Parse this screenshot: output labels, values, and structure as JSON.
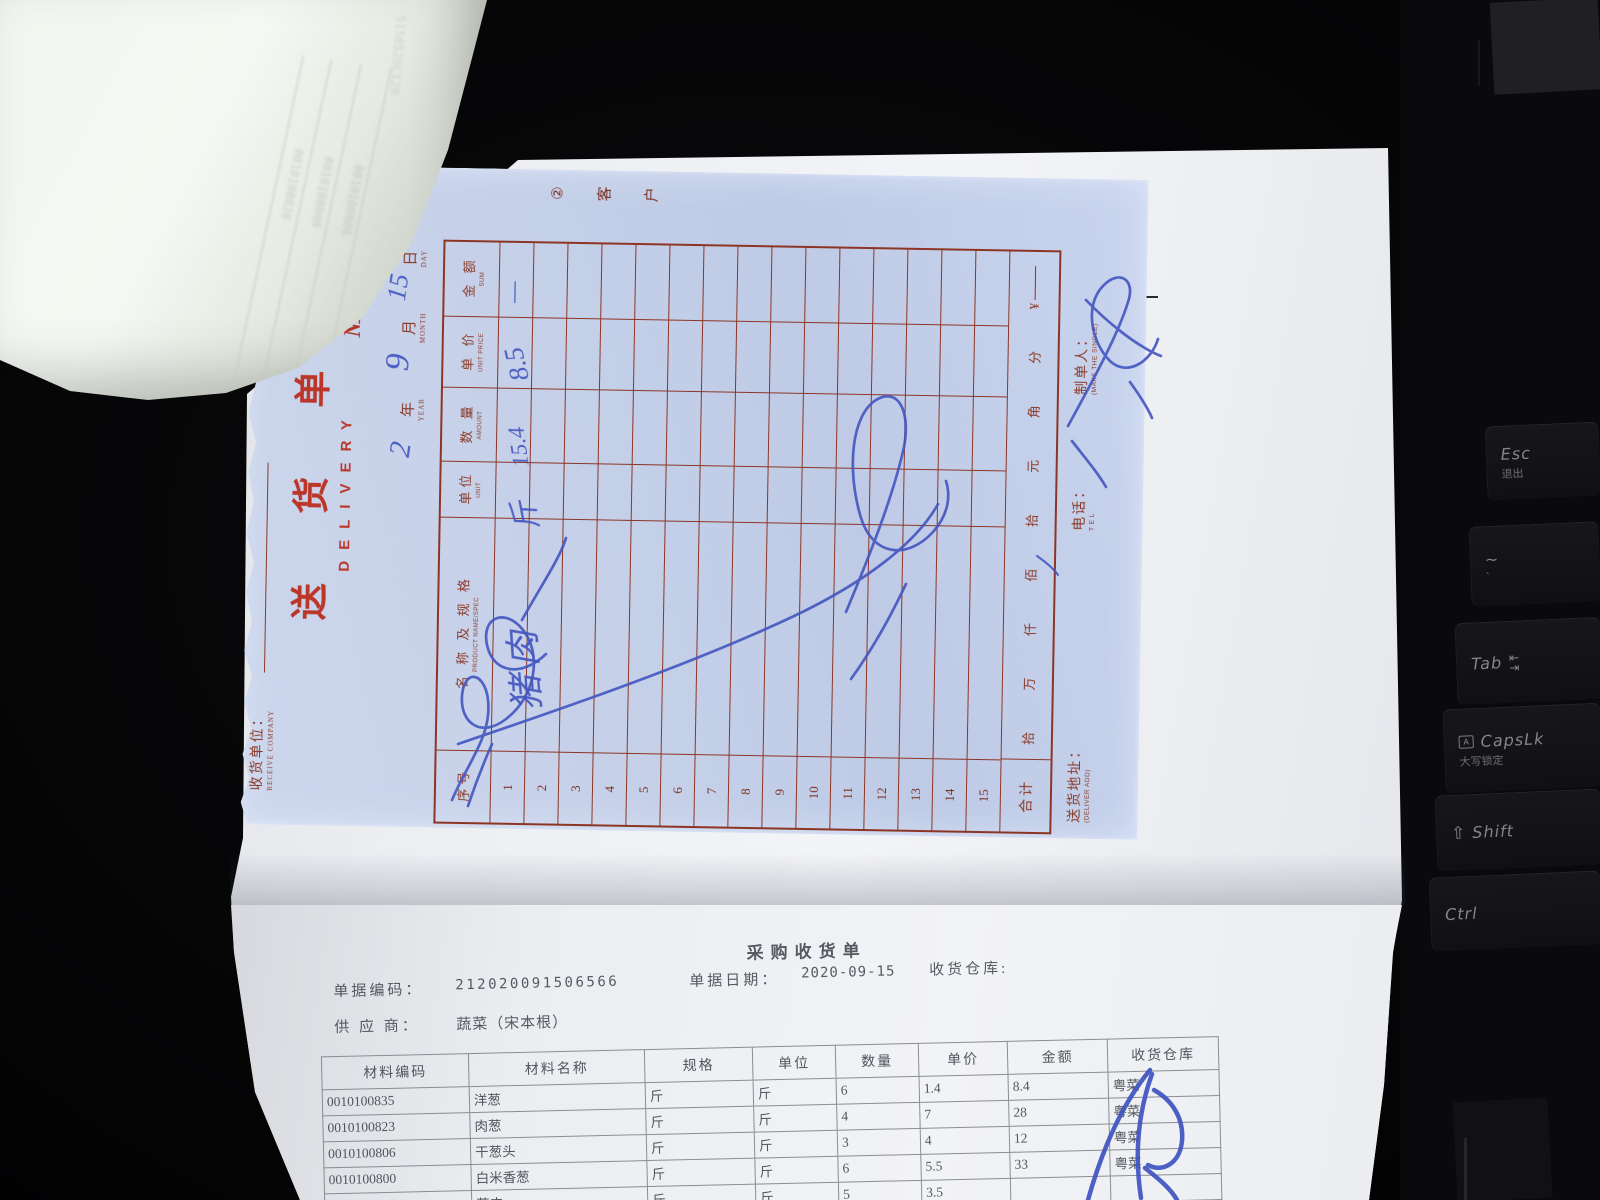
{
  "scene": {
    "background_color": "#060607",
    "note_paper_color": "#c6d1e9",
    "note_print_color": "#8a3a28",
    "note_red_color": "#bb3629",
    "stamp_blue_color": "#5b6fd0",
    "pen_blue_color": "#4456c0",
    "doc_paper_color": "#f0f1f4",
    "doc_ink_color": "#3d4049"
  },
  "delivery_note": {
    "title_cn": "送 货 单",
    "title_en": "DELIVERY",
    "no_label": "№",
    "no_value": "13356",
    "copy_circle": "②",
    "copy_char_1": "客",
    "copy_char_2": "户",
    "company": {
      "label": "收货单位：",
      "sub": "RECEIVE COMPANY"
    },
    "date": {
      "year": "年",
      "year_sub": "YEAR",
      "month": "月",
      "month_sub": "MONTH",
      "day": "日",
      "day_sub": "DAY"
    },
    "handwriting": {
      "year": "2",
      "month": "9",
      "day": "15",
      "row1_name": "猪肉",
      "row1_unit": "斤",
      "row1_amount": "15.4",
      "row1_unit_price": "8.5",
      "row1_sum": "—"
    },
    "table": {
      "columns": [
        {
          "cn": "序号",
          "en": ""
        },
        {
          "cn": "名 称 及 规 格",
          "en": "PRODUCT NAME/SPEC"
        },
        {
          "cn": "单位",
          "en": "UNIT"
        },
        {
          "cn": "数 量",
          "en": "AMOUNT"
        },
        {
          "cn": "单 价",
          "en": "UNIT PRICE"
        },
        {
          "cn": "金 额",
          "en": "SUM"
        }
      ],
      "row_numbers": [
        "1",
        "2",
        "3",
        "4",
        "5",
        "6",
        "7",
        "8",
        "9",
        "10",
        "11",
        "12",
        "13",
        "14",
        "15"
      ],
      "total_label": "合计",
      "total_units": [
        "拾",
        "万",
        "仟",
        "佰",
        "拾",
        "元",
        "角",
        "分"
      ],
      "currency": "¥"
    },
    "footer": {
      "addr": "送货地址：",
      "addr_sub": "(DELIVER ADD)",
      "tel": "电话：",
      "tel_sub": "T E L",
      "maker": "制单人：",
      "maker_sub": "(MAKE THE SINGLE)"
    }
  },
  "receipt_doc": {
    "title": "采购收货单",
    "code_label": "单据编码：",
    "code": "212020091506566",
    "date_label": "单据日期：",
    "date": "2020-09-15",
    "warehouse_label": "收货仓库:",
    "supplier_label": "供 应 商：",
    "supplier": "蔬菜（宋本根）",
    "table": {
      "headers": [
        "材料编码",
        "材料名称",
        "规格",
        "单位",
        "数量",
        "单价",
        "金额",
        "收货仓库"
      ],
      "rows": [
        [
          "0010100835",
          "洋葱",
          "斤",
          "斤",
          "6",
          "1.4",
          "8.4",
          "粤菜"
        ],
        [
          "0010100823",
          "肉葱",
          "斤",
          "斤",
          "4",
          "7",
          "28",
          "粤菜"
        ],
        [
          "0010100806",
          "干葱头",
          "斤",
          "斤",
          "3",
          "4",
          "12",
          "粤菜"
        ],
        [
          "0010100800",
          "白米香葱",
          "斤",
          "斤",
          "6",
          "5.5",
          "33",
          "粤菜"
        ],
        [
          "0010100833",
          "蒜肉",
          "斤",
          "斤",
          "5",
          "3.5",
          "",
          ""
        ]
      ]
    }
  },
  "underlay": {
    "side_text": "cu"
  },
  "folded_receipt": {
    "show_through_codes": [
      "0010100820",
      "0010100800",
      "0010100806"
    ],
    "diagonal_code": "5150520C120"
  },
  "keyboard": {
    "keys": [
      {
        "main": "Esc",
        "sub": "退出",
        "icon": ""
      },
      {
        "main": "~",
        "sub": "`",
        "icon": ""
      },
      {
        "main": "Tab",
        "sub": "",
        "icon": "tab-arrows"
      },
      {
        "main": "CapsLk",
        "sub": "大写锁定",
        "icon": "caps-lock"
      },
      {
        "main": "Shift",
        "sub": "",
        "icon": "shift-arrow"
      },
      {
        "main": "Ctrl",
        "sub": "",
        "icon": ""
      }
    ],
    "tab_arrow_in": "⇤",
    "tab_arrow_out": "⇥",
    "shift_arrow": "⇧",
    "caps_letter": "A"
  }
}
